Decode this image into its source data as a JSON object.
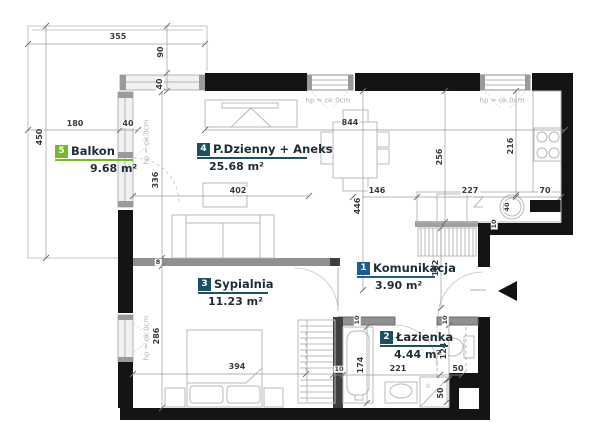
{
  "rooms": [
    {
      "num": "1",
      "name": "Komunikacja",
      "area": "3.90  m²",
      "color": "#1f5c8f"
    },
    {
      "num": "2",
      "name": "Łazienka",
      "area": "4.44  m²",
      "color": "#1b5162"
    },
    {
      "num": "3",
      "name": "Sypialnia",
      "area": "11.23  m²",
      "color": "#1b5162"
    },
    {
      "num": "4",
      "name": "P.Dzienny + Aneks",
      "area": "25.68  m²",
      "color": "#1b5162"
    },
    {
      "num": "5",
      "name": "Balkon",
      "area": "9.68  m²",
      "color": "#76b82a"
    }
  ],
  "dim_labels": [
    {
      "text": "355",
      "x": 118,
      "y": 37
    },
    {
      "text": "90",
      "x": 161,
      "y": 52,
      "v": true
    },
    {
      "text": "40",
      "x": 160,
      "y": 84,
      "v": true
    },
    {
      "text": "180",
      "x": 75,
      "y": 124
    },
    {
      "text": "40",
      "x": 128,
      "y": 124
    },
    {
      "text": "450",
      "x": 40,
      "y": 137,
      "v": true
    },
    {
      "text": "336",
      "x": 156,
      "y": 180,
      "v": true
    },
    {
      "text": "402",
      "x": 238,
      "y": 191
    },
    {
      "text": "844",
      "x": 350,
      "y": 123
    },
    {
      "text": "146",
      "x": 377,
      "y": 191
    },
    {
      "text": "227",
      "x": 470,
      "y": 191
    },
    {
      "text": "70",
      "x": 545,
      "y": 191
    },
    {
      "text": "256",
      "x": 440,
      "y": 157,
      "v": true
    },
    {
      "text": "216",
      "x": 511,
      "y": 146,
      "v": true
    },
    {
      "text": "446",
      "x": 358,
      "y": 206,
      "v": true
    },
    {
      "text": "182",
      "x": 436,
      "y": 268,
      "v": true
    },
    {
      "text": "286",
      "x": 157,
      "y": 336,
      "v": true
    },
    {
      "text": "394",
      "x": 237,
      "y": 367
    },
    {
      "text": "8",
      "x": 158,
      "y": 262,
      "tiny": true
    },
    {
      "text": "10",
      "x": 357,
      "y": 320,
      "v": true,
      "tiny": true
    },
    {
      "text": "10",
      "x": 445,
      "y": 320,
      "v": true,
      "tiny": true
    },
    {
      "text": "10",
      "x": 494,
      "y": 224,
      "v": true,
      "tiny": true
    },
    {
      "text": "10",
      "x": 339,
      "y": 369,
      "tiny": true
    },
    {
      "text": "221",
      "x": 398,
      "y": 369
    },
    {
      "text": "50",
      "x": 458,
      "y": 369
    },
    {
      "text": "174",
      "x": 361,
      "y": 365,
      "v": true
    },
    {
      "text": "124",
      "x": 444,
      "y": 351,
      "v": true
    },
    {
      "text": "50",
      "x": 441,
      "y": 393,
      "v": true
    },
    {
      "text": "40",
      "x": 507,
      "y": 207,
      "v": true,
      "tiny": true
    },
    {
      "text": "hp = ok.0cm",
      "x": 328,
      "y": 101,
      "muted": true
    },
    {
      "text": "hp = ok.0cm",
      "x": 502,
      "y": 101,
      "muted": true
    },
    {
      "text": "hp = ok.0cm",
      "x": 147,
      "y": 142,
      "v": true,
      "muted": true
    },
    {
      "text": "hp = ok.0cm",
      "x": 147,
      "y": 338,
      "v": true,
      "muted": true
    }
  ]
}
